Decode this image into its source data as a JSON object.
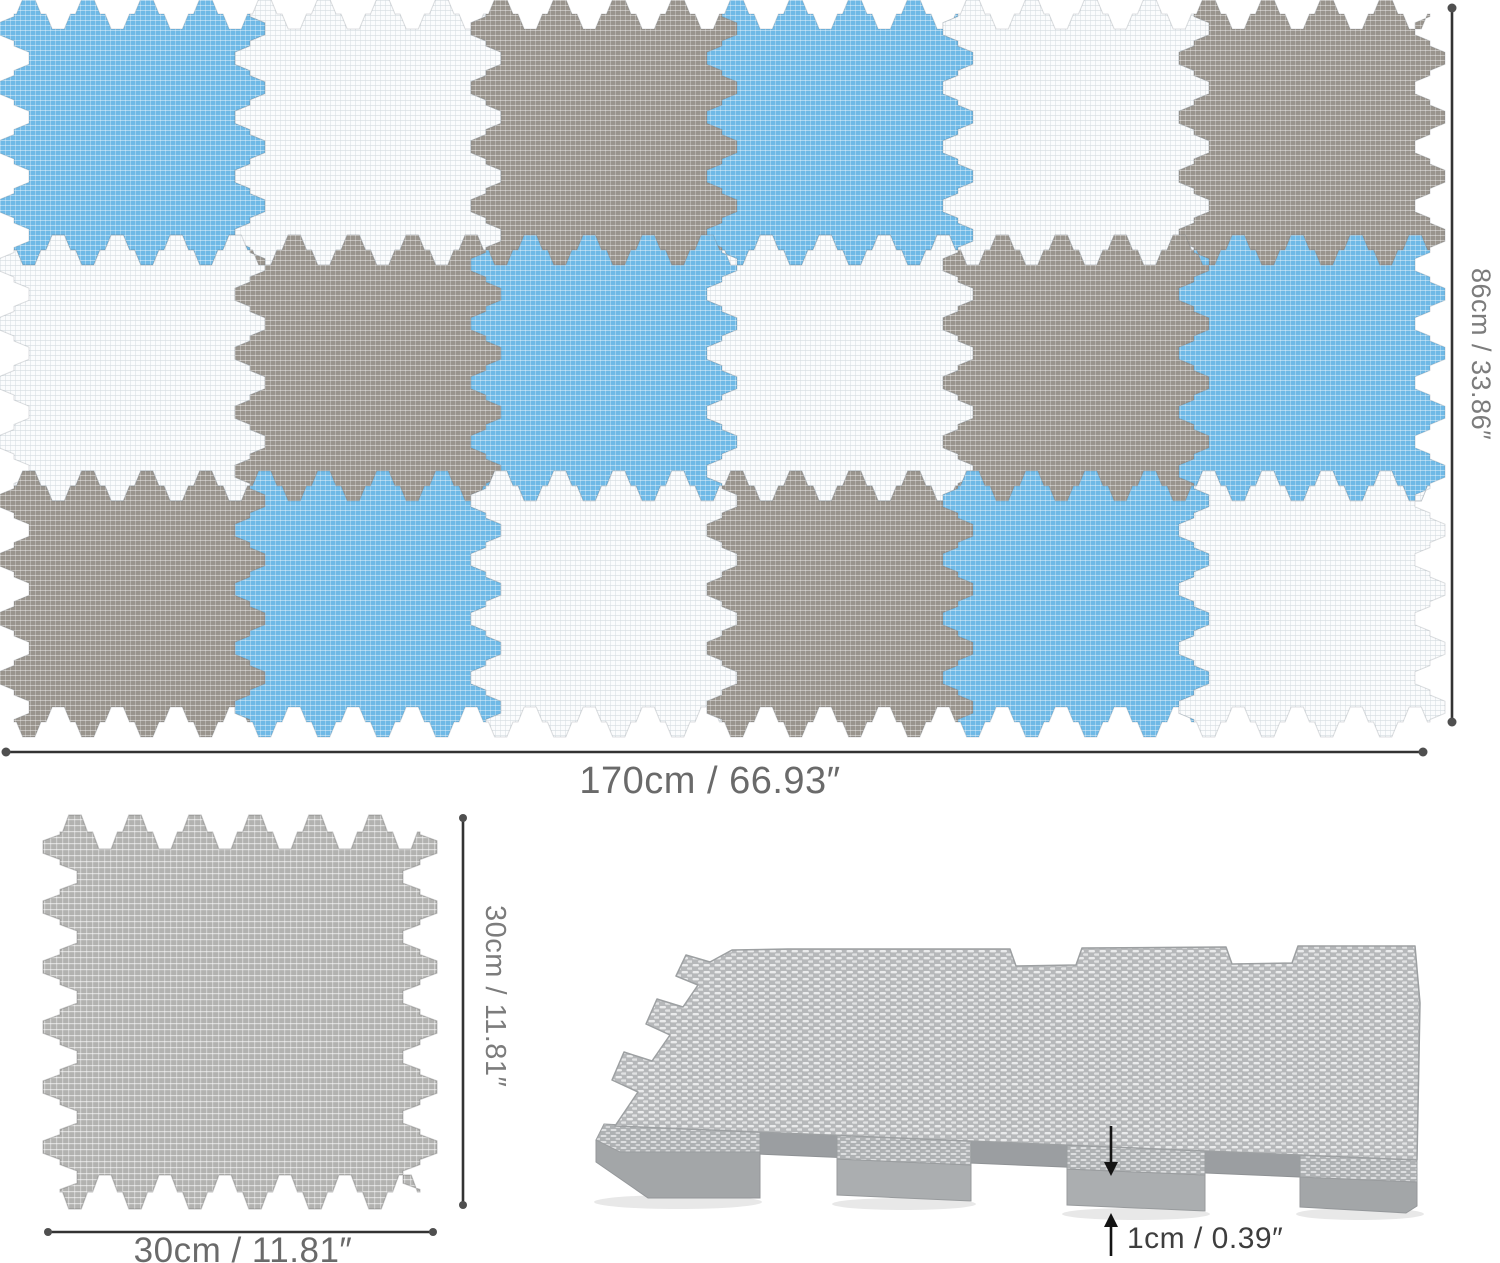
{
  "mat": {
    "rows": 3,
    "cols": 6,
    "pattern": [
      [
        "blue",
        "white",
        "gray",
        "blue",
        "white",
        "gray"
      ],
      [
        "white",
        "gray",
        "blue",
        "white",
        "gray",
        "blue"
      ],
      [
        "gray",
        "blue",
        "white",
        "gray",
        "blue",
        "white"
      ]
    ],
    "colors": {
      "blue": "#6FB9E6",
      "white": "#FBFCFD",
      "gray": "#99948D",
      "lightgray": "#B2B2B0"
    }
  },
  "dimensions": {
    "mat_width": "170cm / 66.93″",
    "mat_height": "86cm / 33.86″",
    "tile_width": "30cm / 11.81″",
    "tile_height": "30cm / 11.81″",
    "thickness": "1cm / 0.39″"
  }
}
